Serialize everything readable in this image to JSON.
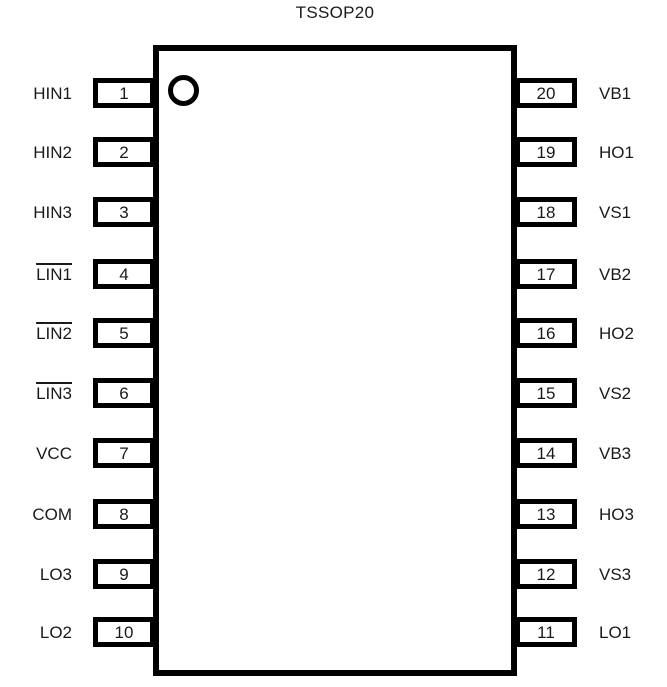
{
  "title": "TSSOP20",
  "package": {
    "type": "pinout-diagram",
    "pin_count": 20,
    "colors": {
      "line": "#000000",
      "background": "#ffffff",
      "text": "#1a1a1a"
    },
    "left_pins": [
      {
        "number": "1",
        "name": "HIN1",
        "overline": false
      },
      {
        "number": "2",
        "name": "HIN2",
        "overline": false
      },
      {
        "number": "3",
        "name": "HIN3",
        "overline": false
      },
      {
        "number": "4",
        "name": "LIN1",
        "overline": true
      },
      {
        "number": "5",
        "name": "LIN2",
        "overline": true
      },
      {
        "number": "6",
        "name": "LIN3",
        "overline": true
      },
      {
        "number": "7",
        "name": "VCC",
        "overline": false
      },
      {
        "number": "8",
        "name": "COM",
        "overline": false
      },
      {
        "number": "9",
        "name": "LO3",
        "overline": false
      },
      {
        "number": "10",
        "name": "LO2",
        "overline": false
      }
    ],
    "right_pins": [
      {
        "number": "20",
        "name": "VB1"
      },
      {
        "number": "19",
        "name": "HO1"
      },
      {
        "number": "18",
        "name": "VS1"
      },
      {
        "number": "17",
        "name": "VB2"
      },
      {
        "number": "16",
        "name": "HO2"
      },
      {
        "number": "15",
        "name": "VS2"
      },
      {
        "number": "14",
        "name": "VB3"
      },
      {
        "number": "13",
        "name": "HO3"
      },
      {
        "number": "12",
        "name": "VS3"
      },
      {
        "number": "11",
        "name": "LO1"
      }
    ]
  }
}
